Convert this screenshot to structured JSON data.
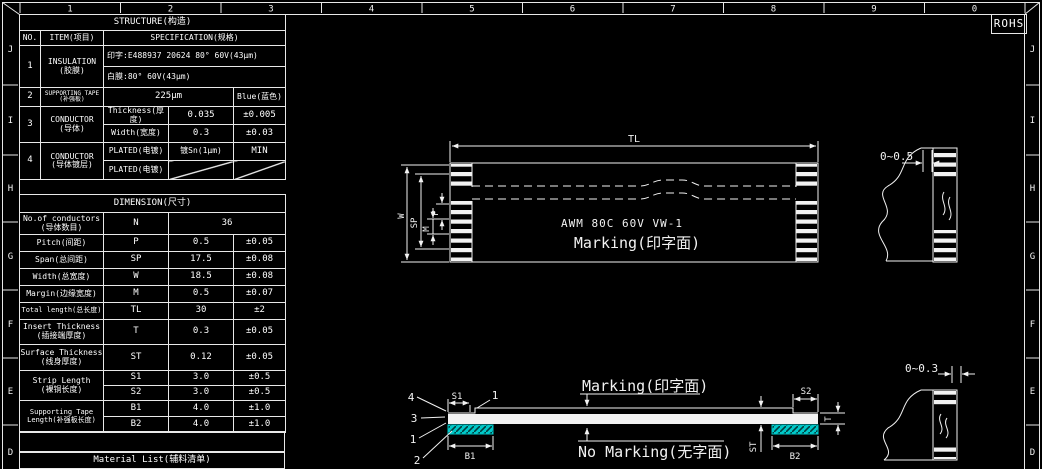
{
  "frame": {
    "rohs_label": "ROHS",
    "zone_numbers": [
      "1",
      "2",
      "3",
      "4",
      "5",
      "6",
      "7",
      "8",
      "9",
      "0"
    ],
    "zone_letters": [
      "J",
      "I",
      "H",
      "G",
      "F",
      "E",
      "D"
    ]
  },
  "colors": {
    "background": "#000000",
    "line": "#f2f2f2",
    "tape_cyan": "#00c8c8",
    "dim_label_red": "#cf4f5f"
  },
  "structure_table": {
    "title": "STRUCTURE(构造)",
    "col_no": "NO.",
    "col_item": "ITEM(项目)",
    "col_spec": "SPECIFICATION(规格)",
    "rows": {
      "insulation": {
        "no": "1",
        "item_en": "INSULATION",
        "item_cn": "(胶膜)",
        "spec_print": "印字:E488937 20624 80° 60V(43μm)",
        "spec_white": "白膜:80° 60V(43μm)"
      },
      "supporting_tape": {
        "no": "2",
        "item_en": "SUPPORTING TAPE",
        "item_cn": "(补强板)",
        "thickness": "225μm",
        "color": "Blue(蓝色)"
      },
      "conductor": {
        "no": "3",
        "item_en": "CONDUCTOR",
        "item_cn": "(导体)",
        "thickness_label": "Thickness(厚度)",
        "thickness_value": "0.035",
        "thickness_tol": "±0.005",
        "width_label": "Width(宽度)",
        "width_value": "0.3",
        "width_tol": "±0.03"
      },
      "conductor_plating": {
        "no": "4",
        "item_en": "CONDUCTOR",
        "item_cn": "(导体镀层)",
        "plated_label": "PLATED(电镀)",
        "plated_value": "镀Sn(1μm)",
        "plated_tol": "MIN",
        "plated_label2": "PLATED(电镀)"
      }
    }
  },
  "dimension_table": {
    "title": "DIMENSION(尺寸)",
    "rows": [
      {
        "label_en": "No.of conductors",
        "label_cn": "(导体数目)",
        "symbol": "N",
        "value": "36",
        "tol": ""
      },
      {
        "label_en": "Pitch(间距)",
        "label_cn": "",
        "symbol": "P",
        "value": "0.5",
        "tol": "±0.05"
      },
      {
        "label_en": "Span(总间距)",
        "label_cn": "",
        "symbol": "SP",
        "value": "17.5",
        "tol": "±0.08"
      },
      {
        "label_en": "Width(总宽度)",
        "label_cn": "",
        "symbol": "W",
        "value": "18.5",
        "tol": "±0.08"
      },
      {
        "label_en": "Margin(边缘宽度)",
        "label_cn": "",
        "symbol": "M",
        "value": "0.5",
        "tol": "±0.07"
      },
      {
        "label_en": "Total length(总长度)",
        "label_cn": "",
        "symbol": "TL",
        "value": "30",
        "tol": "±2"
      },
      {
        "label_en": "Insert Thickness",
        "label_cn": "(插接端厚度)",
        "symbol": "T",
        "value": "0.3",
        "tol": "±0.05"
      },
      {
        "label_en": "Surface Thickness",
        "label_cn": "(线身厚度)",
        "symbol": "ST",
        "value": "0.12",
        "tol": "±0.05"
      }
    ],
    "strip_length": {
      "label_en": "Strip Length",
      "label_cn": "(裸铜长度)",
      "rows": [
        {
          "symbol": "S1",
          "value": "3.0",
          "tol": "±0.5"
        },
        {
          "symbol": "S2",
          "value": "3.0",
          "tol": "±0.5"
        }
      ]
    },
    "supporting_tape_length": {
      "label_en": "Supporting Tape",
      "label_cn": "Length(补强板长度)",
      "rows": [
        {
          "symbol": "B1",
          "value": "4.0",
          "tol": "±1.0"
        },
        {
          "symbol": "B2",
          "value": "4.0",
          "tol": "±1.0"
        }
      ]
    }
  },
  "material_list": {
    "title": "Material List(辅料清单)"
  },
  "top_view": {
    "dim_total_length": "TL",
    "dim_width": "W",
    "dim_span": "SP",
    "dim_margin": "M",
    "dim_pitch": "P",
    "marking_line1": "AWM 80C 60V VW-1",
    "marking_line2": "Marking(印字面)",
    "end_detail_dim": "0~0.5"
  },
  "side_view": {
    "marking_label": "Marking(印字面)",
    "no_marking_label": "No Marking(无字面)",
    "dim_s1": "S1",
    "dim_s2": "S2",
    "dim_b1": "B1",
    "dim_b2": "B2",
    "dim_st": "ST",
    "dim_t": "T",
    "callout_top": "1",
    "callouts": [
      "4",
      "3",
      "1",
      "2"
    ],
    "end_detail_dim": "0~0.3"
  }
}
